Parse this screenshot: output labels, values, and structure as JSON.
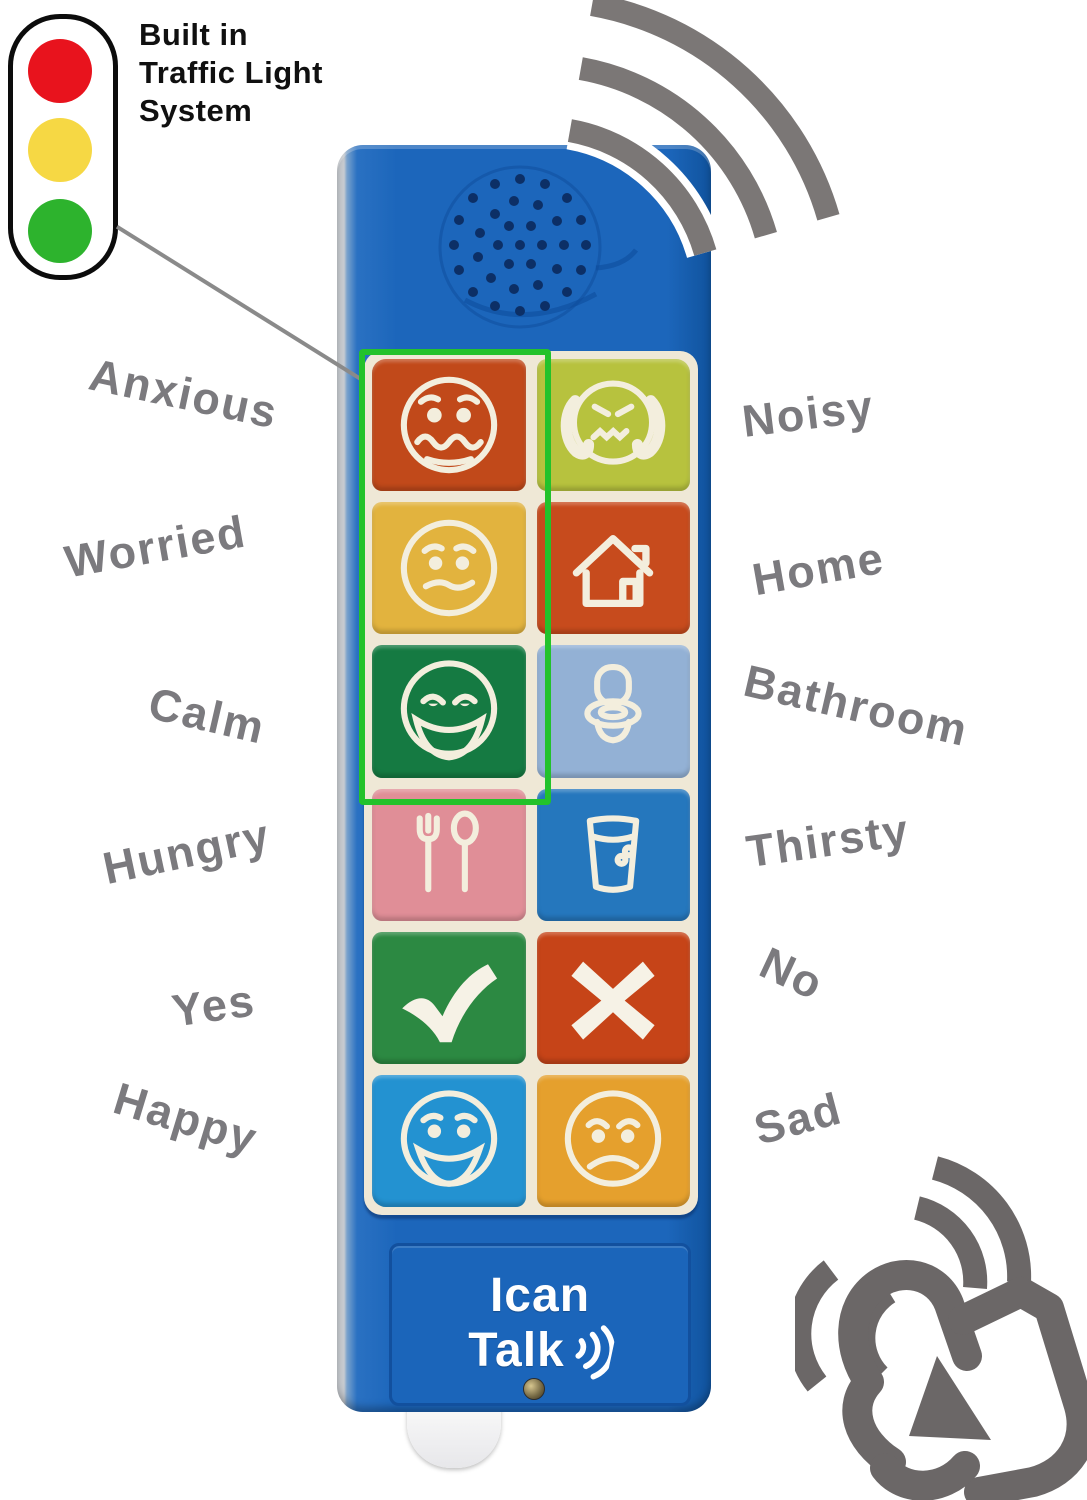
{
  "traffic_light": {
    "caption_lines": [
      "Built in",
      "Traffic Light",
      "System"
    ],
    "colors": {
      "red": "#e8131d",
      "amber": "#f6d844",
      "green": "#2db32d"
    }
  },
  "device": {
    "body_color": "#1c66bb",
    "highlight_box_color": "#23c22b",
    "brand": {
      "line1": "Ican",
      "line2": "Talk"
    }
  },
  "keys": [
    {
      "label": "Anxious",
      "color": "#c1491a",
      "icon": "anxious-face-icon"
    },
    {
      "label": "Noisy",
      "color": "#b7c23e",
      "icon": "noisy-face-icon"
    },
    {
      "label": "Worried",
      "color": "#e2b33e",
      "icon": "worried-face-icon"
    },
    {
      "label": "Home",
      "color": "#c74b1d",
      "icon": "home-icon"
    },
    {
      "label": "Calm",
      "color": "#157a42",
      "icon": "calm-face-icon"
    },
    {
      "label": "Bathroom",
      "color": "#93b1d5",
      "icon": "toilet-icon"
    },
    {
      "label": "Hungry",
      "color": "#e08e97",
      "icon": "fork-spoon-icon"
    },
    {
      "label": "Thirsty",
      "color": "#2577bd",
      "icon": "water-glass-icon"
    },
    {
      "label": "Yes",
      "color": "#2c8942",
      "icon": "checkmark-icon"
    },
    {
      "label": "No",
      "color": "#c64418",
      "icon": "cross-icon"
    },
    {
      "label": "Happy",
      "color": "#2392d1",
      "icon": "happy-face-icon"
    },
    {
      "label": "Sad",
      "color": "#e5a02d",
      "icon": "sad-face-icon"
    }
  ],
  "label_color": "#7b7a7e"
}
